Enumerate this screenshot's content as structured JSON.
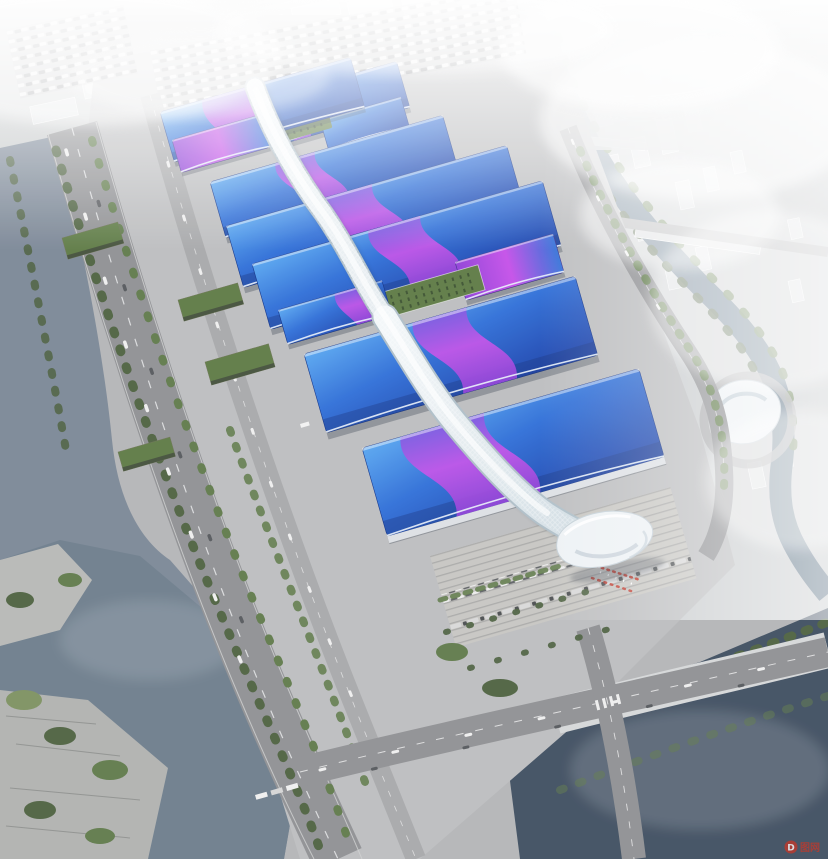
{
  "meta": {
    "title": "Aerial rendering of riverside exhibition and convention center",
    "type": "architectural-rendering"
  },
  "scene": {
    "landmarks": [
      "exhibition-halls",
      "central-ribbon-corridor",
      "entrance-shell",
      "top-parking-lot",
      "west-highway",
      "west-canal",
      "waterfront-park",
      "south-river",
      "east-river",
      "city-skyline",
      "swirl-landmark-building",
      "entrance-plaza"
    ]
  },
  "watermark": {
    "icon_letter": "D",
    "text": "图网",
    "color": "#c0392b"
  },
  "colors": {
    "ground": "#b4b5b7",
    "apron": "#bcbdbf",
    "plaza": "#c7c6c2",
    "road": "#8f9093",
    "road-dark": "#7b7c7f",
    "road-light": "#a7a8aa",
    "bridge": "#d8dadc",
    "water-canal": "#7b8796",
    "water-river": "#6d7d8c",
    "water-dark": "#3f4e60",
    "water-green": "#5d7386",
    "tree-1": "#4d6140",
    "tree-2": "#5f7a4a",
    "lawn": "#7d9160",
    "roof-garden": "#5d7a44",
    "city-1": "#dde0e2",
    "city-2": "#c9ccce",
    "roof-a": "#58a6f0",
    "roof-b": "#2f6fd8",
    "roof-c": "#1b44ae",
    "roof-deep": "#14327f",
    "swoosh-a": "#7d55e0",
    "swoosh-b": "#c44fe8",
    "swoosh-c": "#8f3fd8",
    "ribbon-a": "#f3f7f9",
    "ribbon-b": "#ccd9e0",
    "shell": "#eef2f5",
    "shell-shade": "#c5d0d8",
    "shadow": "#202c3a",
    "accent-red": "#c0392b",
    "car-light": "#efefef",
    "car-dark": "#55585c"
  }
}
